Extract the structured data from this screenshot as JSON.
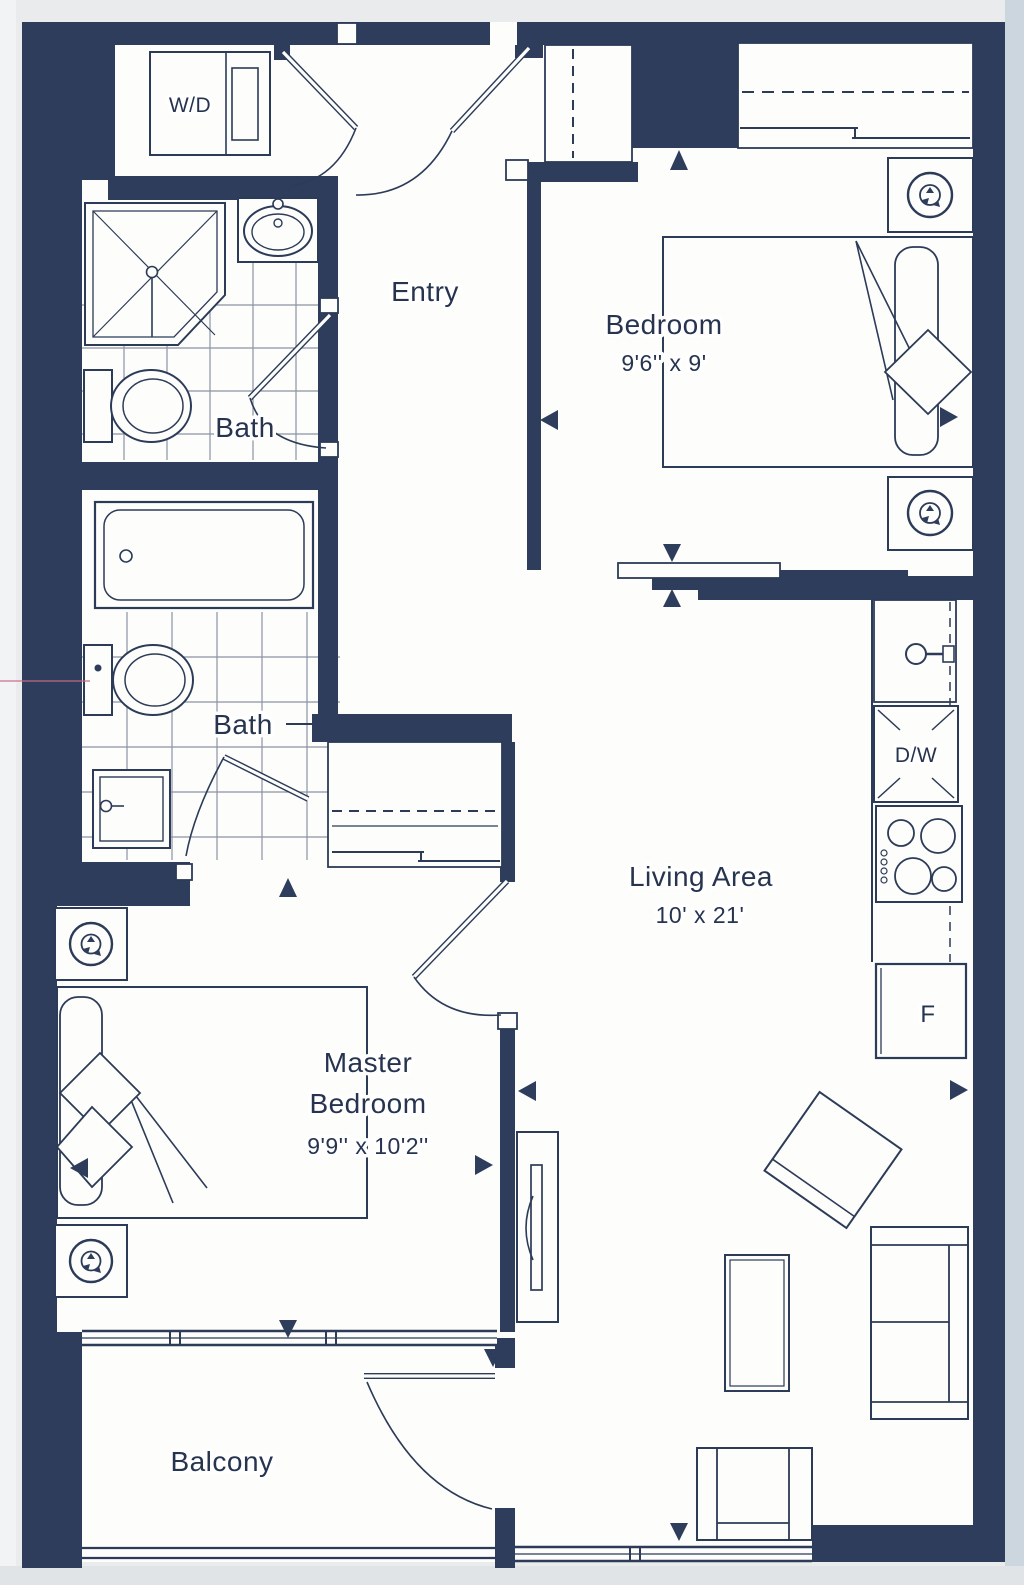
{
  "plan": {
    "rooms": {
      "entry": {
        "label": "Entry"
      },
      "bath_upper": {
        "label": "Bath"
      },
      "bath_lower": {
        "label": "Bath"
      },
      "bedroom": {
        "label": "Bedroom",
        "dimensions": "9'6'' x 9'"
      },
      "living": {
        "label": "Living Area",
        "dimensions": "10' x 21'"
      },
      "master": {
        "label_line1": "Master",
        "label_line2": "Bedroom",
        "dimensions": "9'9'' x 10'2''"
      },
      "balcony": {
        "label": "Balcony"
      }
    },
    "appliances": {
      "washer_dryer": "W/D",
      "dishwasher": "D/W",
      "fridge": "F"
    },
    "colors": {
      "wall": "#2e3d5c",
      "line": "#2c3b57",
      "text": "#263450",
      "floor": "#fdfdfc",
      "page": "#e9ebed",
      "page_right_strip": "#ccd6df",
      "scan_line": "#c96b85"
    }
  }
}
